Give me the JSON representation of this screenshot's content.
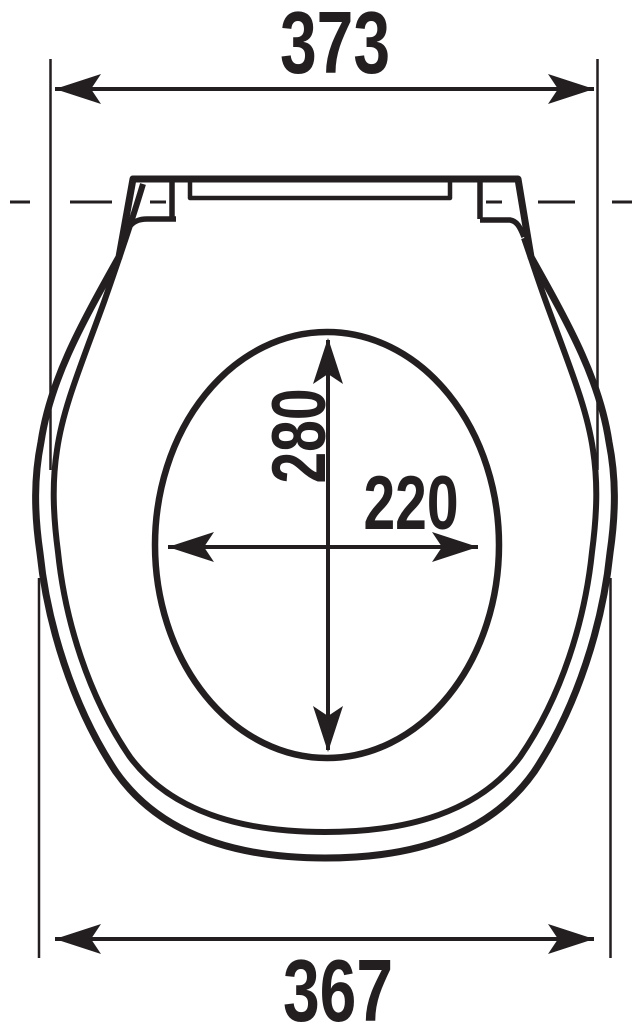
{
  "diagram": {
    "type": "technical-drawing",
    "subject": "toilet-seat-top-view-with-dimensions",
    "colors": {
      "line": "#231f20",
      "background": "#ffffff"
    },
    "dimensions": {
      "top_width": {
        "value": "373",
        "orientation": "horizontal",
        "position": "top"
      },
      "bottom_width": {
        "value": "367",
        "orientation": "horizontal",
        "position": "bottom"
      },
      "hole_length": {
        "value": "280",
        "orientation": "vertical-rotated",
        "position": "inside-hole"
      },
      "hole_width": {
        "value": "220",
        "orientation": "horizontal",
        "position": "inside-hole"
      }
    },
    "features": {
      "hinge_centerline": "dashed",
      "seat_contour": "double-line",
      "hole_shape": "ellipse",
      "arrow_style": "swallow-tail-double-headed"
    }
  }
}
